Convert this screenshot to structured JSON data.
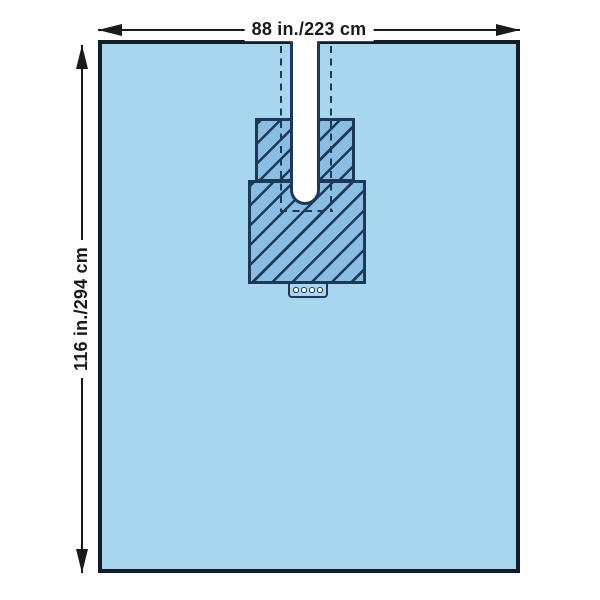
{
  "diagram": {
    "width_label": "88 in./223 cm",
    "height_label": "116 in./294 cm",
    "tab_hole_count": 4
  },
  "colors": {
    "background": "#ffffff",
    "drape_fill": "#a9d6ef",
    "reinforcement_fill": "#8abce4",
    "line": "#1c3a57",
    "drape_outline": "#141d27",
    "dimension": "#1a1a1a"
  }
}
